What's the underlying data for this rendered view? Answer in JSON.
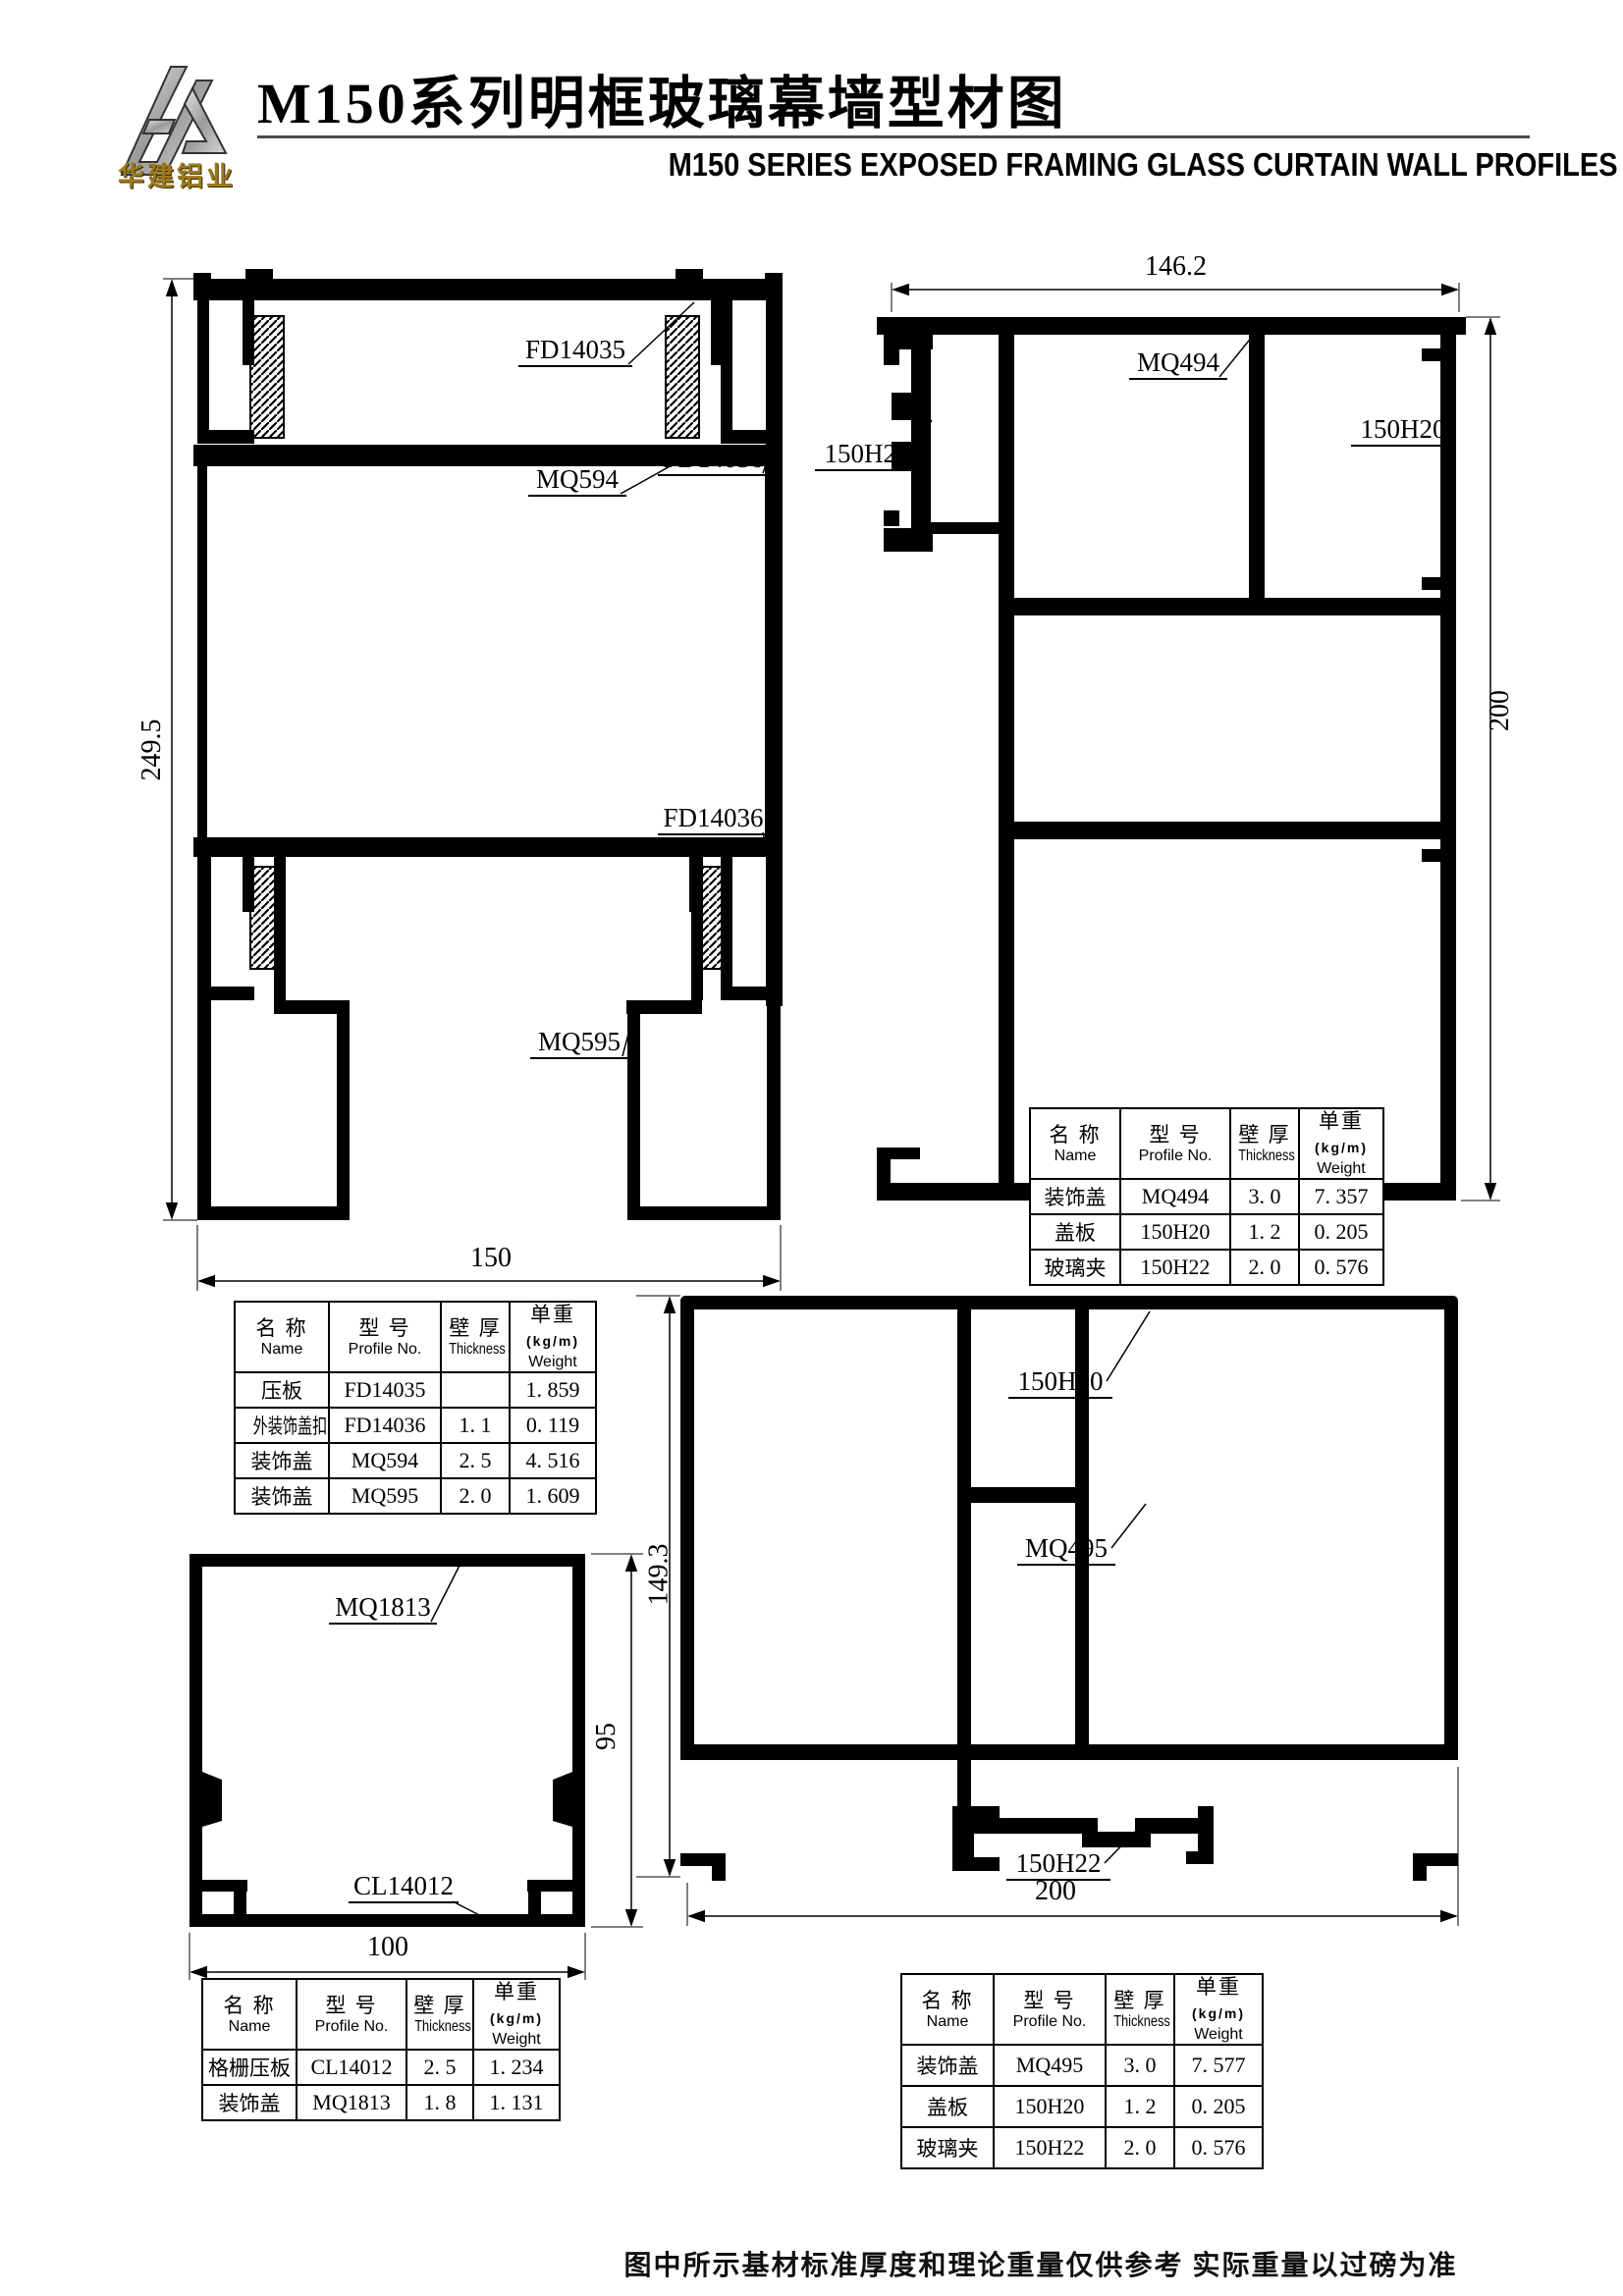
{
  "header": {
    "logo_text": "华建铝业",
    "title_cn": "M150系列明框玻璃幕墙型材图",
    "title_en": "M150  SERIES EXPOSED FRAMING GLASS CURTAIN WALL PROFILES"
  },
  "drawings": {
    "d1": {
      "labels": {
        "fd14035": "FD14035",
        "mq594": "MQ594",
        "fd14036_a": "FD14036",
        "fd14036_b": "FD14036",
        "mq595": "MQ595"
      },
      "dims": {
        "height": "249.5",
        "width": "150"
      }
    },
    "d2": {
      "labels": {
        "mq494": "MQ494",
        "h20": "150H20",
        "h22": "150H22"
      },
      "dims": {
        "width": "146.2",
        "height": "200"
      }
    },
    "d3": {
      "labels": {
        "mq1813": "MQ1813",
        "cl14012": "CL14012"
      },
      "dims": {
        "height": "95",
        "width": "100"
      }
    },
    "d4": {
      "labels": {
        "h20": "150H20",
        "mq495": "MQ495",
        "h22": "150H22"
      },
      "dims": {
        "height": "149.3",
        "width": "200"
      }
    }
  },
  "table_header": {
    "name_cn": "名 称",
    "name_en": "Name",
    "model_cn": "型 号",
    "model_en": "Profile No.",
    "thickness_cn": "壁 厚",
    "thickness_en": "Thickness",
    "weight_cn": "单重",
    "weight_unit": "(kg/m)",
    "weight_en": "Weight"
  },
  "tables": {
    "t1": {
      "rows": [
        {
          "name": "装饰盖",
          "model": "MQ494",
          "thickness": "3. 0",
          "weight": "7. 357"
        },
        {
          "name": "盖板",
          "model": "150H20",
          "thickness": "1. 2",
          "weight": "0. 205"
        },
        {
          "name": "玻璃夹",
          "model": "150H22",
          "thickness": "2. 0",
          "weight": "0. 576"
        }
      ]
    },
    "t2": {
      "rows": [
        {
          "name": "压板",
          "model": "FD14035",
          "thickness": "",
          "weight": "1. 859"
        },
        {
          "name": "外装饰盖扣盖",
          "model": "FD14036",
          "thickness": "1. 1",
          "weight": "0. 119"
        },
        {
          "name": "装饰盖",
          "model": "MQ594",
          "thickness": "2. 5",
          "weight": "4. 516"
        },
        {
          "name": "装饰盖",
          "model": "MQ595",
          "thickness": "2. 0",
          "weight": "1. 609"
        }
      ]
    },
    "t3": {
      "rows": [
        {
          "name": "格栅压板",
          "model": "CL14012",
          "thickness": "2. 5",
          "weight": "1. 234"
        },
        {
          "name": "装饰盖",
          "model": "MQ1813",
          "thickness": "1. 8",
          "weight": "1. 131"
        }
      ]
    },
    "t4": {
      "rows": [
        {
          "name": "装饰盖",
          "model": "MQ495",
          "thickness": "3. 0",
          "weight": "7. 577"
        },
        {
          "name": "盖板",
          "model": "150H20",
          "thickness": "1. 2",
          "weight": "0. 205"
        },
        {
          "name": "玻璃夹",
          "model": "150H22",
          "thickness": "2. 0",
          "weight": "0. 576"
        }
      ]
    }
  },
  "footer": {
    "note": "图中所示基材标准厚度和理论重量仅供参考 实际重量以过磅为准"
  }
}
